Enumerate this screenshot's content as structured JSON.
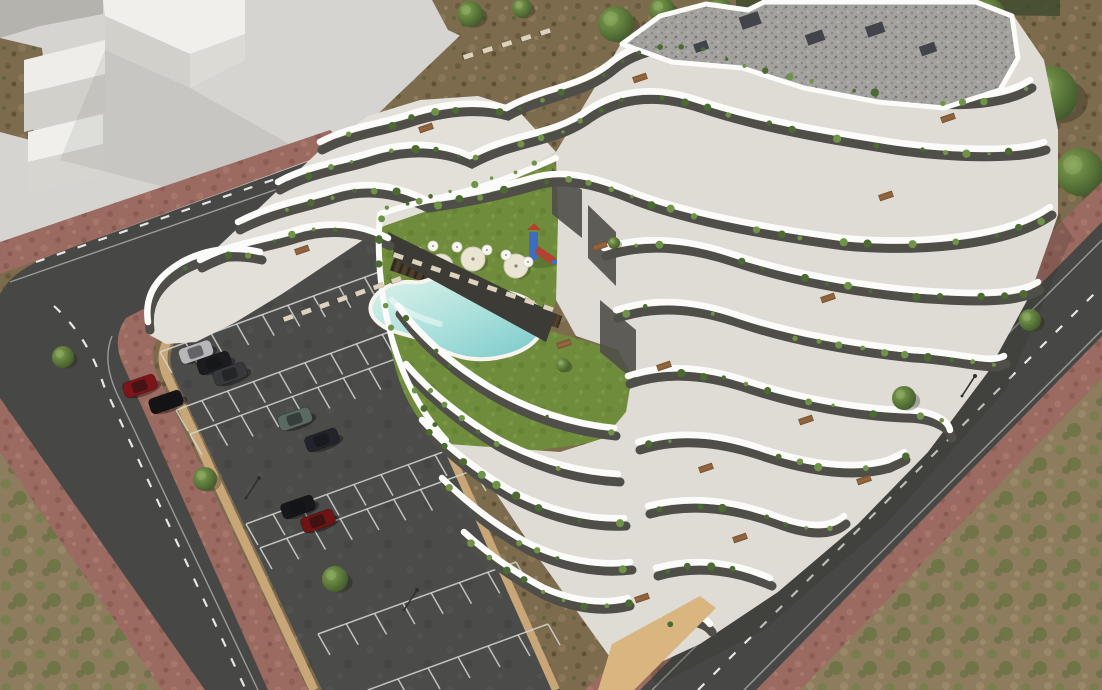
{
  "scene": {
    "type": "3d-architectural-aerial-render",
    "subject": "aerial view of a modern white terraced apartment complex with courtyard lawn, free-form swimming pool, wood deck, sun loungers, parasols, playground, walled parking lot with cars, perimeter asphalt roads with brick sidewalks, a plain white neighbouring building massing and surrounding scrubland with trees",
    "elements": [
      "apartment-building",
      "gravel-roof",
      "terraced-balconies",
      "courtyard-lawn",
      "swimming-pool",
      "wood-deck",
      "sun-loungers",
      "parasols",
      "playground",
      "parking-lot",
      "parked-cars",
      "retaining-walls",
      "perimeter-roads",
      "road-markings",
      "brick-sidewalks",
      "neighbor-building-massing",
      "scrubland",
      "trees",
      "street-lamps"
    ]
  },
  "colors": {
    "concrete": "#d6d4d0",
    "slabTop": "#f0efec",
    "slabFace": "#d2d0cb",
    "slabShade": "#b5b3ae",
    "dirt": "#7d6b4e",
    "scrub": "#8d7c5e",
    "scrubGreen": "#5e7239",
    "road": "#474846",
    "roadLine": "#e8e8e4",
    "sidewalk": "#9b6a60",
    "parking": "#4b4c4a",
    "stall": "#d6d7d3",
    "wall": "#c8a678",
    "tanBase": "#d9b680",
    "lawn": "#6f8c3c",
    "poolRim": "#f5f4ef",
    "poolLight": "#dff2ec",
    "poolDeep": "#79c9cc",
    "deck": "#46382a",
    "floor": "#dfdcd5",
    "floorWing": "#e3e0d9",
    "bandWhite": "#fbfbf9",
    "bandDark": "#4f4e48",
    "glass": "#3c3b36",
    "roofGravel": "#a3a29e",
    "shrub": "#4c6b33",
    "shrubLight": "#6f9447",
    "parasol": "#eae4d3",
    "lounger": "#ddd3bd",
    "wood": "#8a5f3a",
    "treeHi": "#7fa24f",
    "treeLo": "#3f5529",
    "playTower": "#3f6bc0",
    "playSlide": "#b4402f"
  },
  "trees": [
    {
      "x": 470,
      "y": 14,
      "r": 13,
      "layer": "back"
    },
    {
      "x": 522,
      "y": 8,
      "r": 10,
      "layer": "back"
    },
    {
      "x": 616,
      "y": 24,
      "r": 18,
      "layer": "back"
    },
    {
      "x": 662,
      "y": 10,
      "r": 13,
      "layer": "back"
    },
    {
      "x": 720,
      "y": 10,
      "r": 12,
      "layer": "back"
    },
    {
      "x": 762,
      "y": 30,
      "r": 26,
      "layer": "back"
    },
    {
      "x": 830,
      "y": 16,
      "r": 20,
      "layer": "back"
    },
    {
      "x": 906,
      "y": 24,
      "r": 24,
      "layer": "back"
    },
    {
      "x": 988,
      "y": 16,
      "r": 18,
      "layer": "back"
    },
    {
      "x": 1050,
      "y": 94,
      "r": 28,
      "layer": "back"
    },
    {
      "x": 1080,
      "y": 172,
      "r": 24,
      "layer": "back"
    },
    {
      "x": 1088,
      "y": 238,
      "r": 18,
      "layer": "back"
    },
    {
      "x": 63,
      "y": 357,
      "r": 11,
      "layer": "front"
    },
    {
      "x": 205,
      "y": 479,
      "r": 12,
      "layer": "front"
    },
    {
      "x": 335,
      "y": 579,
      "r": 13,
      "layer": "front"
    },
    {
      "x": 904,
      "y": 398,
      "r": 12,
      "layer": "front"
    },
    {
      "x": 1030,
      "y": 320,
      "r": 11,
      "layer": "front"
    },
    {
      "x": 563,
      "y": 365,
      "r": 7,
      "layer": "front"
    },
    {
      "x": 614,
      "y": 243,
      "r": 6,
      "layer": "front"
    }
  ],
  "cars": [
    {
      "x": 196,
      "y": 352,
      "angle": -19,
      "color": "#b7b7b9"
    },
    {
      "x": 214,
      "y": 363,
      "angle": -19,
      "color": "#1c1c1e"
    },
    {
      "x": 230,
      "y": 374,
      "angle": -19,
      "color": "#37383a"
    },
    {
      "x": 140,
      "y": 386,
      "angle": -19,
      "color": "#7d1518"
    },
    {
      "x": 166,
      "y": 402,
      "angle": -19,
      "color": "#141416"
    },
    {
      "x": 295,
      "y": 419,
      "angle": -19,
      "color": "#5a6a62"
    },
    {
      "x": 322,
      "y": 440,
      "angle": -19,
      "color": "#22232b"
    },
    {
      "x": 298,
      "y": 507,
      "angle": -19,
      "color": "#17171a"
    },
    {
      "x": 318,
      "y": 521,
      "angle": -19,
      "color": "#6f1313"
    }
  ],
  "lamps": [
    {
      "x": 246,
      "y": 498
    },
    {
      "x": 404,
      "y": 610
    },
    {
      "x": 962,
      "y": 396
    }
  ],
  "parking_rows": [
    {
      "x1": 160,
      "y1": 352,
      "x2": 390,
      "y2": 268,
      "n": 9,
      "dx": 12,
      "dy": 21
    },
    {
      "x1": 176,
      "y1": 410,
      "x2": 408,
      "y2": 325,
      "n": 9,
      "dx": 12,
      "dy": 21
    },
    {
      "x1": 190,
      "y1": 434,
      "x2": 420,
      "y2": 350,
      "n": 9,
      "dx": 12,
      "dy": 21
    },
    {
      "x1": 246,
      "y1": 524,
      "x2": 462,
      "y2": 445,
      "n": 8,
      "dx": 12,
      "dy": 21
    },
    {
      "x1": 260,
      "y1": 548,
      "x2": 474,
      "y2": 470,
      "n": 8,
      "dx": 12,
      "dy": 21
    },
    {
      "x1": 318,
      "y1": 634,
      "x2": 516,
      "y2": 562,
      "n": 7,
      "dx": 12,
      "dy": 21
    },
    {
      "x1": 368,
      "y1": 690,
      "x2": 548,
      "y2": 624,
      "n": 6,
      "dx": 12,
      "dy": 21
    }
  ],
  "lounger_rows": [
    {
      "x1": 398,
      "y1": 256,
      "x2": 548,
      "y2": 308,
      "n": 9,
      "angle": 19
    },
    {
      "x1": 288,
      "y1": 318,
      "x2": 396,
      "y2": 280,
      "n": 7,
      "angle": -20
    },
    {
      "x1": 468,
      "y1": 56,
      "x2": 545,
      "y2": 32,
      "n": 5,
      "angle": -18
    }
  ],
  "parasols": [
    {
      "x": 441,
      "y": 266,
      "r": 12
    },
    {
      "x": 473,
      "y": 259,
      "r": 12
    },
    {
      "x": 516,
      "y": 266,
      "r": 12
    }
  ],
  "pool_umbrellas": [
    {
      "x": 418,
      "y": 252,
      "r": 5
    },
    {
      "x": 433,
      "y": 246,
      "r": 5
    },
    {
      "x": 457,
      "y": 247,
      "r": 5
    },
    {
      "x": 487,
      "y": 250,
      "r": 5
    },
    {
      "x": 506,
      "y": 255,
      "r": 5
    },
    {
      "x": 528,
      "y": 262,
      "r": 5
    }
  ],
  "picnic_tables": [
    {
      "x": 640,
      "y": 78
    },
    {
      "x": 600,
      "y": 246
    },
    {
      "x": 664,
      "y": 366
    },
    {
      "x": 706,
      "y": 468
    },
    {
      "x": 740,
      "y": 538
    },
    {
      "x": 302,
      "y": 250
    },
    {
      "x": 426,
      "y": 128
    },
    {
      "x": 564,
      "y": 344
    },
    {
      "x": 828,
      "y": 298
    },
    {
      "x": 886,
      "y": 196
    },
    {
      "x": 948,
      "y": 118
    },
    {
      "x": 806,
      "y": 420
    },
    {
      "x": 864,
      "y": 480
    },
    {
      "x": 642,
      "y": 598
    }
  ]
}
